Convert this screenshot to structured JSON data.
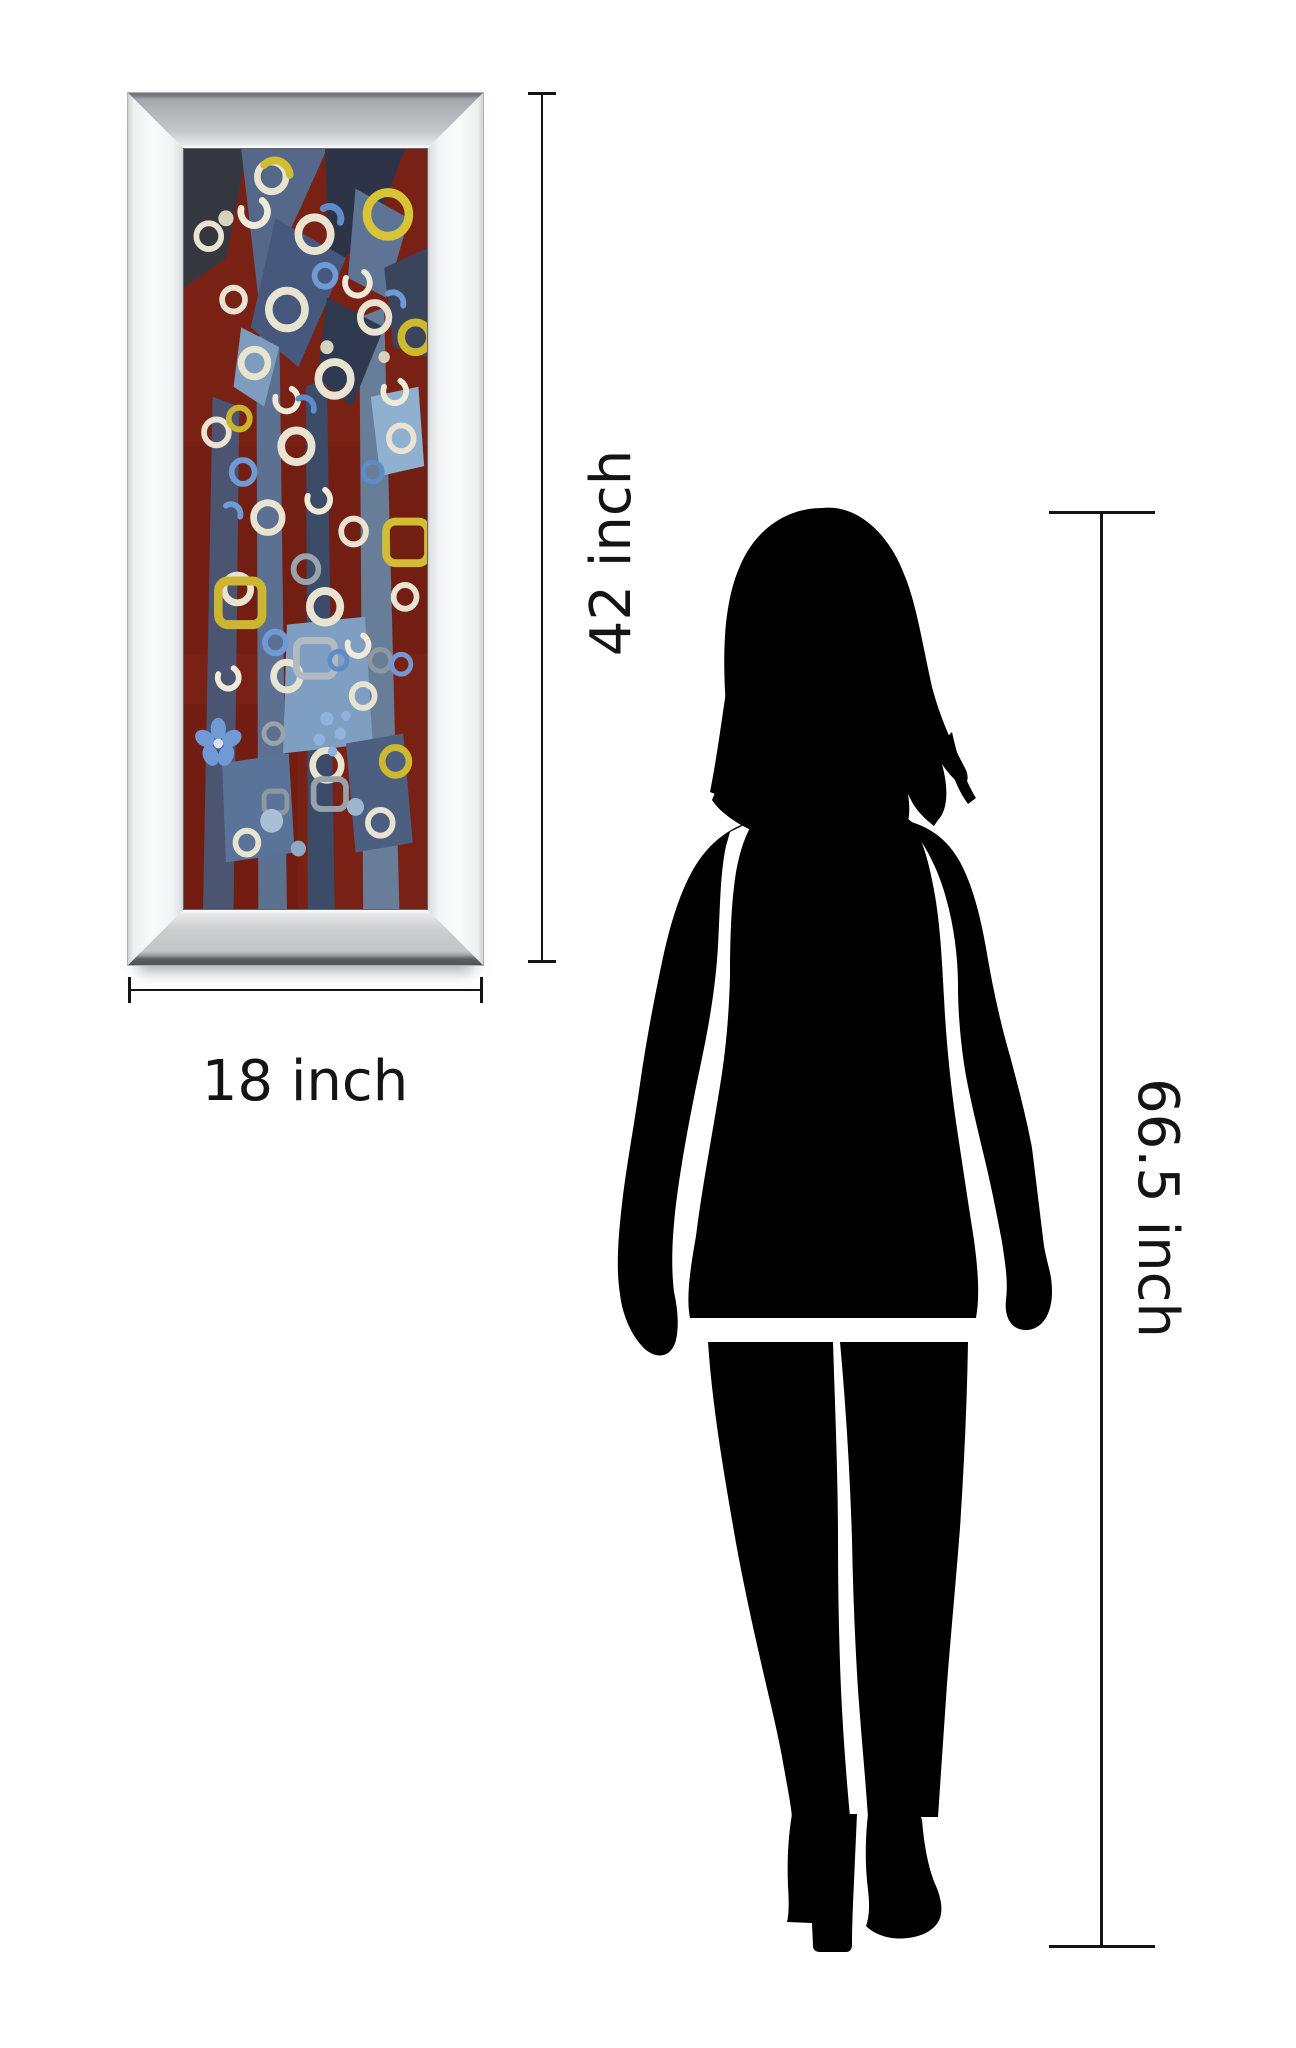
{
  "page": {
    "background_color": "#ffffff",
    "annotation_line_color": "#141414",
    "silhouette_color": "#000000"
  },
  "product": {
    "type": "framed-abstract-wall-art",
    "frame_style": "mirrored-bevel-frame",
    "frame_face_color": "#c4c6c8",
    "frame_side_color": "#fafbfb",
    "art_background_color": "#7a2115",
    "art_accent_colors": [
      "#55688a",
      "#e9e3d1",
      "#d8c437",
      "#6f9ad6",
      "#9aa2ab"
    ]
  },
  "dimensions": {
    "artwork_height": {
      "label": "42 inch"
    },
    "artwork_width": {
      "label": "18 inch"
    },
    "person_height": {
      "label": "66.5 inch"
    }
  },
  "figure": {
    "type": "standing-woman-silhouette"
  }
}
